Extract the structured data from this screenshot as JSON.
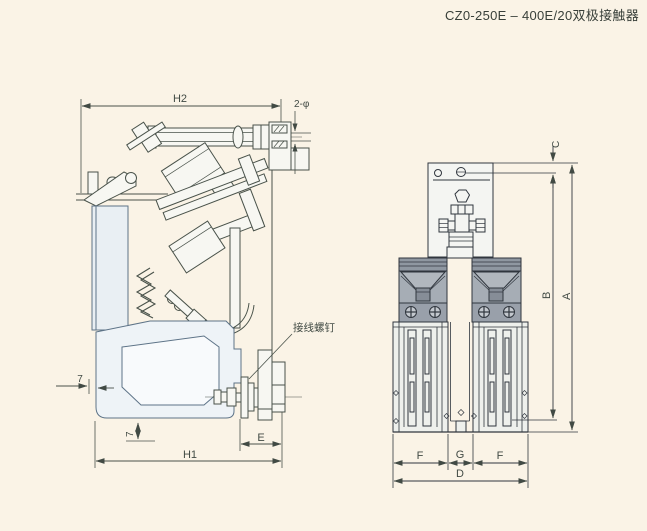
{
  "title": "CZ0-250E – 400E/20双极接触器",
  "colors": {
    "background": "#faf3e6",
    "line_side_view": "#49524a",
    "line_front_view": "#30363e",
    "blue_outline": "#5d7387",
    "chute_gray": "#a6adb5",
    "chute_dark_band": "#8f97a1",
    "screw_band_gray": "#99a0aa"
  },
  "side_view": {
    "dim_h2": "H2",
    "dim_holes": "2-φ",
    "dim_7_left": "7",
    "dim_7_bottom": "7",
    "dim_e": "E",
    "dim_h1": "H1",
    "label_terminal_screw": "接线螺钉"
  },
  "front_view": {
    "dim_c": "C",
    "dim_b": "B",
    "dim_a": "A",
    "dim_f_left": "F",
    "dim_g": "G",
    "dim_f_right": "F",
    "dim_d": "D"
  }
}
